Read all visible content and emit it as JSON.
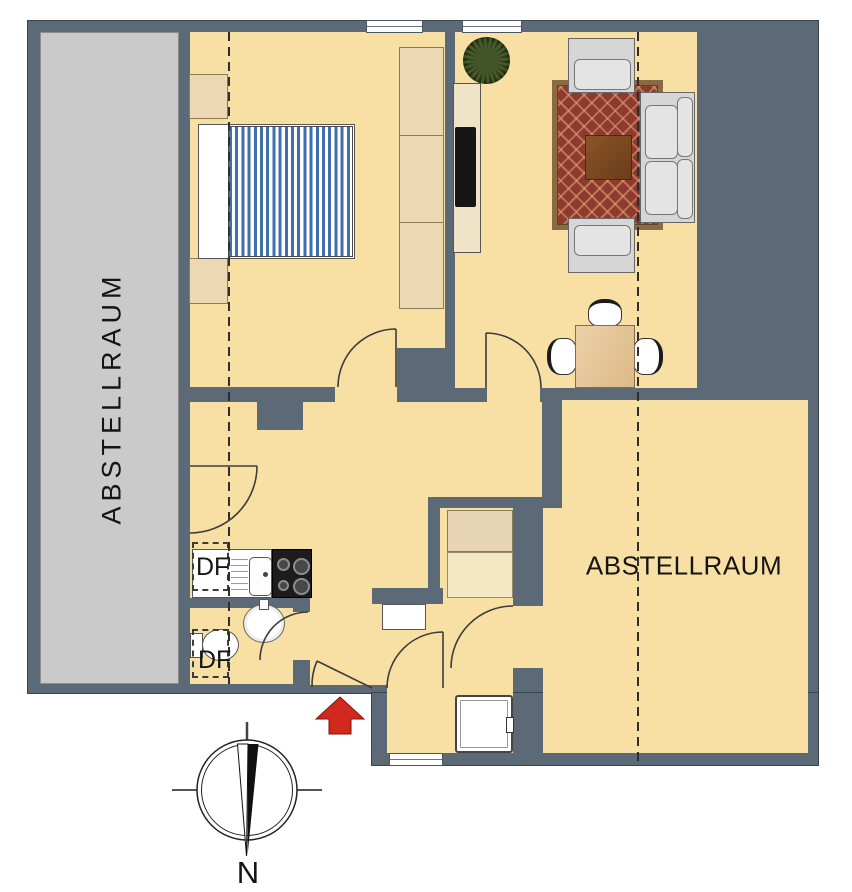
{
  "labels": {
    "storage_left": "ABSTELLRAUM",
    "storage_right": "ABSTELLRAUM",
    "df_top": "DF",
    "df_bottom": "DF",
    "north": "N"
  },
  "colors": {
    "wall": "#5c6a78",
    "floor": "#f8e0a4",
    "storage": "#cacaca",
    "beige": "#ecd9b4",
    "bedblue": "#3f6fae",
    "rugred": "#8e3a2e",
    "rugborder": "#8a6a42",
    "arrowred": "#d3281e"
  },
  "icons": {
    "compass": "compass-rose-icon",
    "entrance_arrow": "entrance-arrow-icon",
    "plant": "plant-icon"
  },
  "furniture": [
    "double-bed",
    "nightstands",
    "wardrobe",
    "tv-board",
    "tv",
    "sofa",
    "armchairs",
    "rug",
    "coffee-table",
    "dining-table",
    "chairs",
    "kitchen-counter",
    "sink",
    "stove",
    "washbasin",
    "toilet",
    "shower",
    "closets"
  ]
}
